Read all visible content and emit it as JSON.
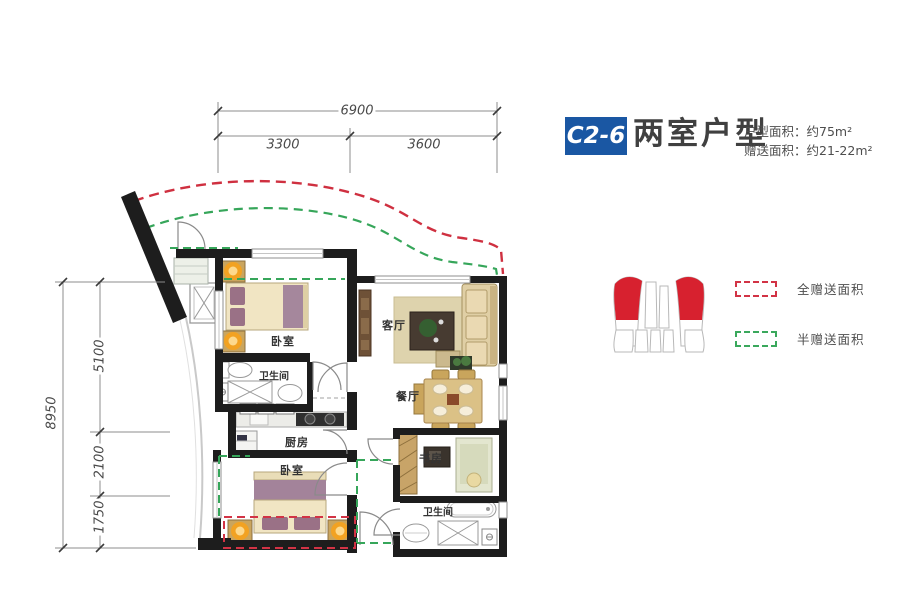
{
  "header": {
    "unit_code": "C2-6",
    "unit_type": "两室户型",
    "area_line1": "户型面积：约75m²",
    "area_line2": "赠送面积：约21-22m²"
  },
  "legend": {
    "items": [
      {
        "label": "全赠送面积",
        "color": "#d23345",
        "style": "red-dashed"
      },
      {
        "label": "半赠送面积",
        "color": "#3aa85c",
        "style": "green-dashed"
      }
    ],
    "building_icon": "site-key-building-with-red-highlighted-units"
  },
  "dimensions": {
    "top_total": "6900",
    "top_left": "3300",
    "top_right": "3600",
    "left_total": "8950",
    "left_seg1": "5100",
    "left_seg2": "2100",
    "left_seg3": "1750"
  },
  "rooms": {
    "bedroom_top": "卧室",
    "bathroom_top": "卫生间",
    "kitchen": "厨房",
    "bedroom_bottom": "卧室",
    "living": "客厅",
    "dining": "餐厅",
    "study": "书房",
    "bathroom_bottom": "卫生间"
  },
  "colors": {
    "accent_blue": "#1a57a3",
    "full_bonus_red": "#d23345",
    "half_bonus_green": "#3aa85c",
    "wall_black": "#1d1d1d"
  }
}
